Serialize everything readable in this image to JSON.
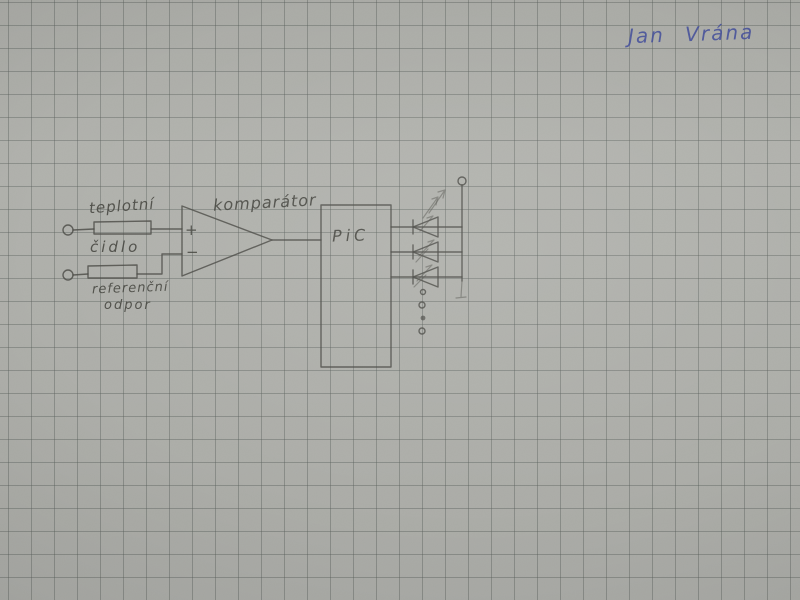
{
  "photo": {
    "description": "Photograph of a hand-drawn electronic schematic, pencil on gray squared (graph) paper",
    "signature_text": "Jan Vrána"
  },
  "labels": {
    "sensor_line1": "teplotní",
    "sensor_line2": "čidlo",
    "reference_line1": "referenční",
    "reference_line2": "odpor",
    "comparator": "komparátor",
    "mcu": "PiC",
    "plus": "+",
    "minus": "−"
  },
  "components": [
    "input terminal (top, open circle)",
    "input terminal (bottom, open circle)",
    "resistor box labelled teplotní čidlo (temperature sensor)",
    "resistor box labelled referenční odpor (reference resistor)",
    "comparator (op-amp triangle with + and − inputs)",
    "PiC microcontroller block",
    "LED ×3 with light-emission arrows",
    "ellipsis dots for further outputs",
    "common output rail with terminal circle"
  ],
  "colors": {
    "paper": "#b2b3ae",
    "grid_line": "#878b86",
    "pencil": "#4c4c47",
    "pen_blue": "#4450a0"
  }
}
